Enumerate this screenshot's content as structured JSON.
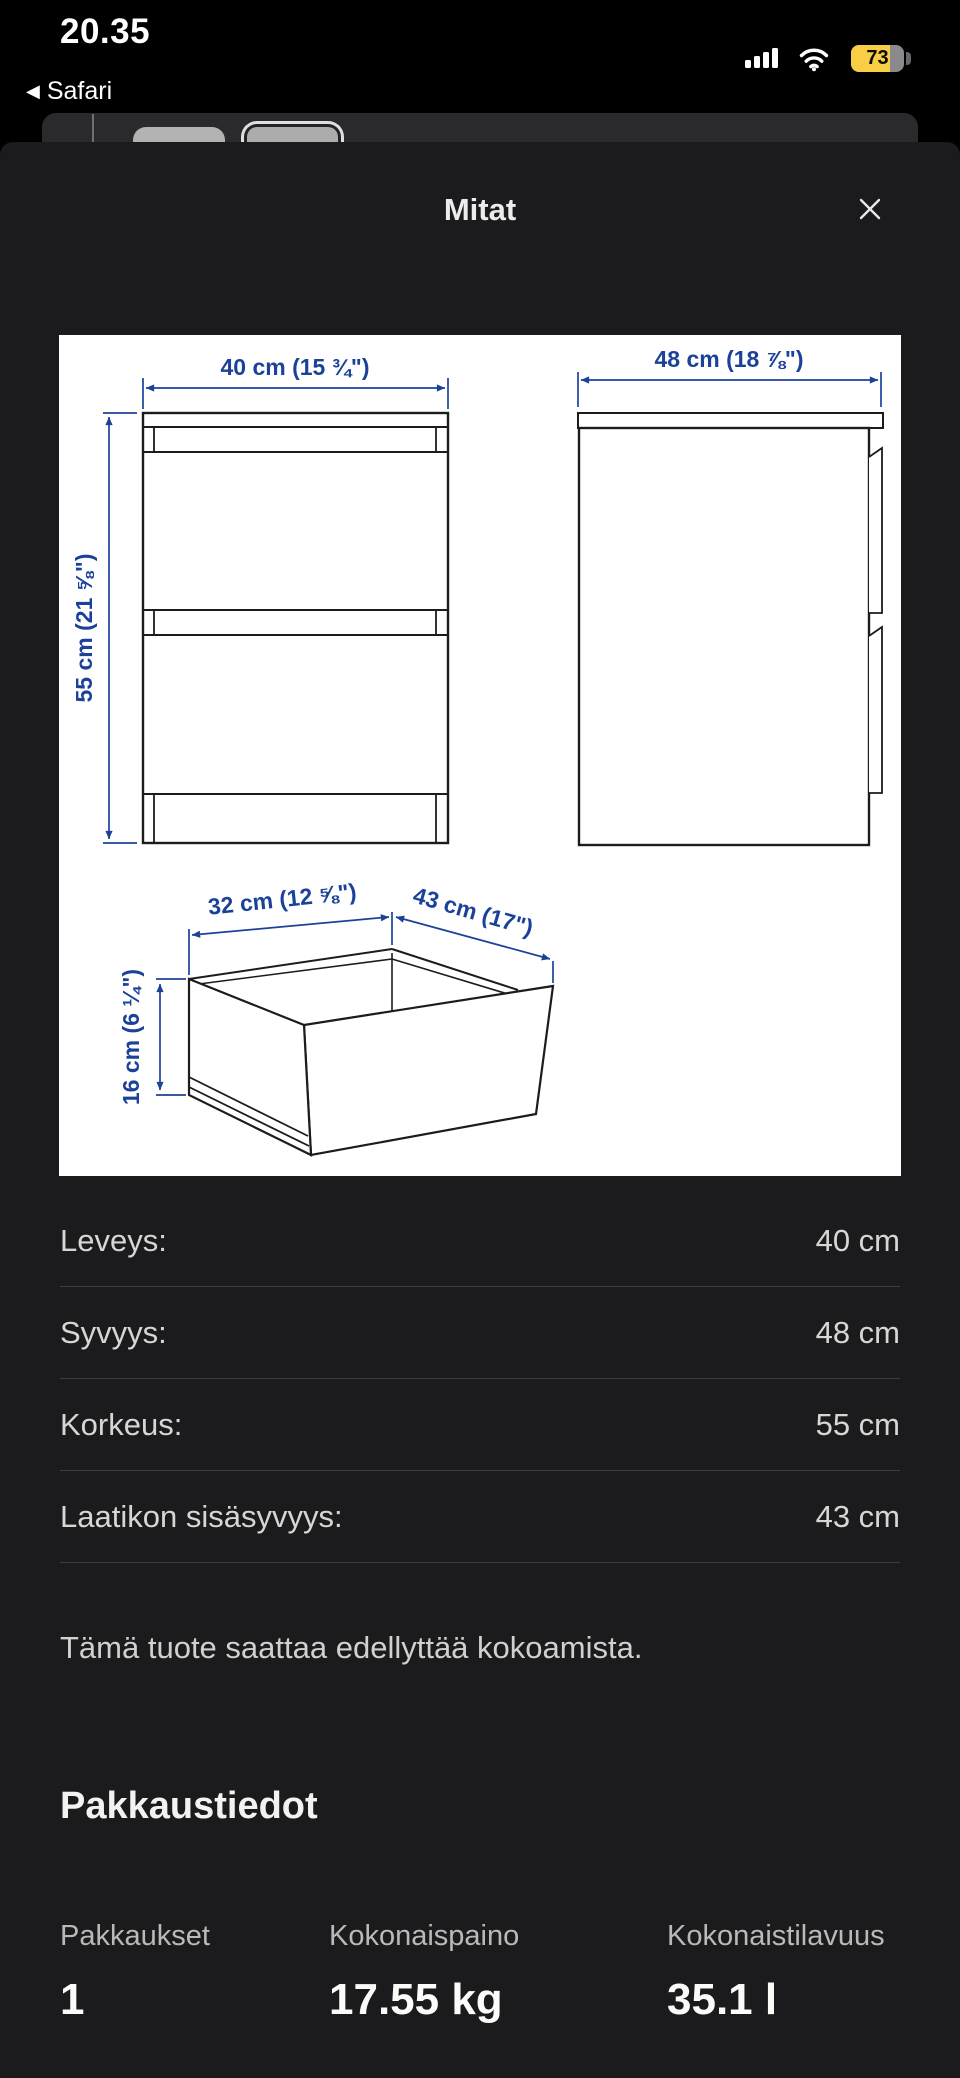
{
  "status_bar": {
    "time": "20.35",
    "back_label": "Safari",
    "back_chevron": "◀",
    "battery_percent": "73",
    "battery_color": "#f7ce45"
  },
  "sheet": {
    "title": "Mitat",
    "background": "#1b1b1d"
  },
  "diagram": {
    "dimension_color": "#1b4298",
    "line_color": "#1c1c1c",
    "front_width_label": "40 cm (15 ¾\")",
    "front_height_label": "55 cm (21 ⅝\")",
    "side_depth_label": "48 cm (18 ⅞\")",
    "drawer_width_label": "32 cm (12 ⅝\")",
    "drawer_depth_label": "43 cm (17\")",
    "drawer_height_label": "16 cm (6 ¼\")"
  },
  "dimensions": {
    "rows": [
      {
        "label": "Leveys:",
        "value": "40 cm"
      },
      {
        "label": "Syvyys:",
        "value": "48 cm"
      },
      {
        "label": "Korkeus:",
        "value": "55 cm"
      },
      {
        "label": "Laatikon sisäsyvyys:",
        "value": "43 cm"
      }
    ]
  },
  "note": "Tämä tuote saattaa edellyttää kokoamista.",
  "packaging": {
    "heading": "Pakkaustiedot",
    "columns": [
      {
        "label": "Pakkaukset",
        "value": "1"
      },
      {
        "label": "Kokonaispaino",
        "value": "17.55 kg"
      },
      {
        "label": "Kokonaistilavuus",
        "value": "35.1 l"
      }
    ]
  }
}
